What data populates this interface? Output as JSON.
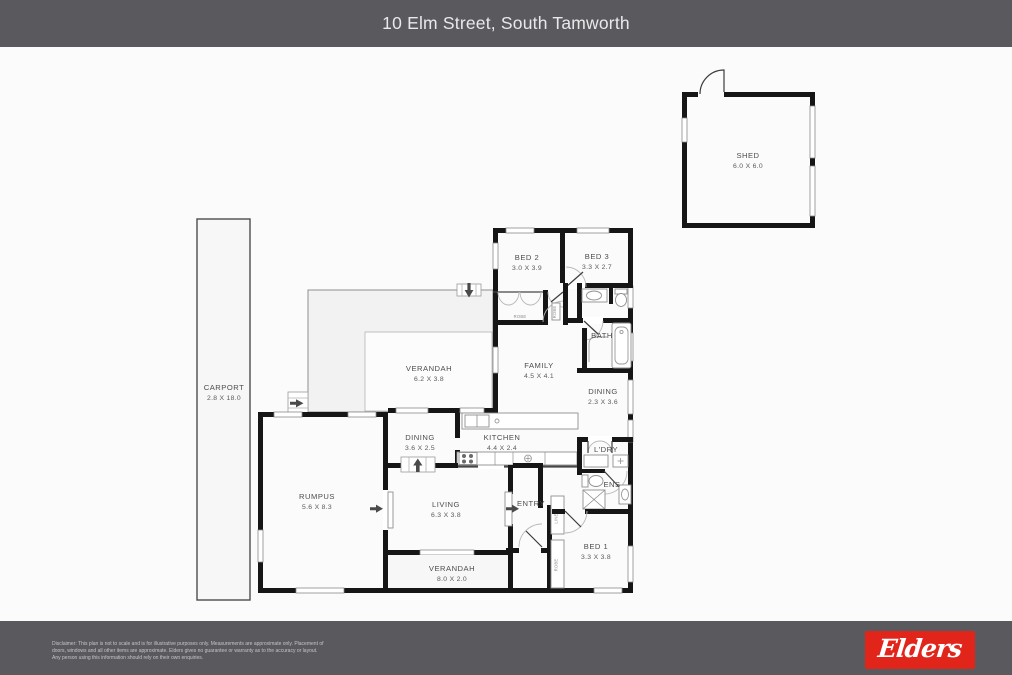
{
  "header": {
    "title": "10 Elm Street, South Tamworth"
  },
  "colors": {
    "header_bg": "#5a5a5e",
    "footer_bg": "#5a5a5e",
    "logo_red": "#e1251b",
    "plan_bg": "#fbfbfb",
    "wall": "#161616",
    "verandah_fill": "#f2f2f2"
  },
  "floorplan": {
    "shed": {
      "name": "SHED",
      "dims": "6.0 X 6.0"
    },
    "carport": {
      "name": "CARPORT",
      "dims": "2.8 X 18.0"
    },
    "bed2": {
      "name": "BED 2",
      "dims": "3.0 X 3.9"
    },
    "bed3": {
      "name": "BED 3",
      "dims": "3.3 X 2.7"
    },
    "bath": {
      "name": "BATH"
    },
    "family": {
      "name": "FAMILY",
      "dims": "4.5 X 4.1"
    },
    "dining_right": {
      "name": "DINING",
      "dims": "2.3 X 3.6"
    },
    "verandah_top": {
      "name": "VERANDAH",
      "dims": "6.2 X 3.8"
    },
    "dining_left": {
      "name": "DINING",
      "dims": "3.6 X 2.5"
    },
    "kitchen": {
      "name": "KITCHEN",
      "dims": "4.4 X 2.4"
    },
    "laundry": {
      "name": "L'DRY"
    },
    "ensuite": {
      "name": "ENS"
    },
    "rumpus": {
      "name": "RUMPUS",
      "dims": "5.6 X 8.3"
    },
    "living": {
      "name": "LIVING",
      "dims": "6.3 X 3.8"
    },
    "entry": {
      "name": "ENTRY"
    },
    "bed1": {
      "name": "BED 1",
      "dims": "3.3 X 3.8"
    },
    "verandah_bottom": {
      "name": "VERANDAH",
      "dims": "8.0 X 2.0"
    },
    "robe_bed2": {
      "name": "ROBE"
    },
    "robe_hall": {
      "name": "ROBE"
    },
    "linen": {
      "name": "LINEN"
    },
    "robe_bed1": {
      "name": "ROBE"
    }
  },
  "footer": {
    "disclaimer_line1": "Disclaimer: This plan is not to scale and is for illustrative purposes only. Measurements are approximate only. Placement of",
    "disclaimer_line2": "doors, windows and all other items are approximate. Elders gives no guarantee or warranty as to the accuracy or layout.",
    "disclaimer_line3": "Any person using this information should rely on their own enquiries.",
    "logo_text": "Elders"
  }
}
